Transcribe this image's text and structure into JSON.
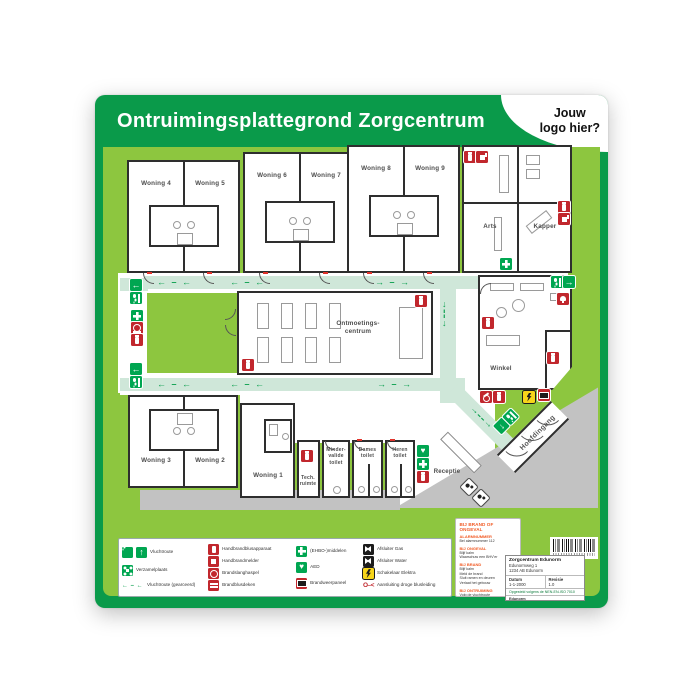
{
  "poster": {
    "title": "Ontruimingsplattegrond Zorgcentrum",
    "logo_placeholder": "Jouw\nlogo hier?"
  },
  "rooms": {
    "w1": "Woning 1",
    "w2": "Woning 2",
    "w3": "Woning 3",
    "w4": "Woning 4",
    "w5": "Woning 5",
    "w6": "Woning 6",
    "w7": "Woning 7",
    "w8": "Woning 8",
    "w9": "Woning 9",
    "arts": "Arts",
    "kapper": "Kapper",
    "winkel": "Winkel",
    "ontmoetingscentrum": "Ontmoetings-\ncentrum",
    "receptie": "Receptie",
    "tech_ruimte": "Tech.\nruimte",
    "mindervalide_toilet": "Minder-\nvalide\ntoilet",
    "dames_toilet": "Dames\ntoilet",
    "heren_toilet": "Heren\ntoilet",
    "hoofdingang": "Hoofdingang"
  },
  "legend": {
    "green": [
      {
        "icon": "escape-route",
        "label": "Vluchtroute"
      },
      {
        "icon": "assembly-point",
        "label": "Verzamelplaats"
      },
      {
        "icon": "route-dashes",
        "label": "Vluchtroute (gearceerd)"
      }
    ],
    "red": [
      {
        "icon": "extinguisher",
        "label": "Handbrandblusapparaat"
      },
      {
        "icon": "manual-call-point",
        "label": "Handbrandmelder"
      },
      {
        "icon": "hose-reel",
        "label": "Brandslanghaspel"
      },
      {
        "icon": "fire-blanket",
        "label": "Brandblusdeken"
      }
    ],
    "aid": [
      {
        "icon": "first-aid",
        "label": "(EHBO-)middelen"
      },
      {
        "icon": "aed",
        "label": "AED"
      },
      {
        "icon": "fire-panel",
        "label": "Brandweerpaneel"
      }
    ],
    "utilities": [
      {
        "icon": "valve",
        "label": "Afsluiter Gas"
      },
      {
        "icon": "valve",
        "label": "Afsluiter Water"
      },
      {
        "icon": "electric-switch",
        "label": "Schakelaar Elektra"
      },
      {
        "icon": "dry-riser",
        "label": "Aansluiting droge blusleiding"
      }
    ]
  },
  "emergency_instructions": {
    "title": "BIJ BRAND OF ONGEVAL",
    "sections": [
      {
        "heading": "ALARMNUMMER",
        "lines": "Bel alarmnummer 112"
      },
      {
        "heading": "BIJ ONGEVAL",
        "lines": "Blijf kalm\nWaarschuw een BHV'er"
      },
      {
        "heading": "BIJ BRAND",
        "lines": "Blijf kalm\nMeld de brand\nSluit ramen en deuren\nVerlaat het gebouw"
      },
      {
        "heading": "BIJ ONTRUIMING",
        "lines": "Volg de vluchtroute\nGebruik geen lift\nGa naar de verzamelplaats"
      }
    ]
  },
  "info_box": {
    "name": "Zorgcentrum Edunorm",
    "address_line1": "Edunormweg 1",
    "address_line2": "1234 AB Edunorm",
    "date_label": "Datum",
    "date_value": "1-1-2000",
    "revision_label": "Revisie",
    "revision_value": "1.0",
    "norm_line": "Opgesteld volgens de NEN-EN-ISO 7010",
    "publisher": "Edunorm"
  },
  "colors": {
    "green_dark": "#0a9a4a",
    "green_light": "#8dc63f",
    "route_mint": "#cfe7d9",
    "safety_red": "#c1272d",
    "safety_green": "#00a651",
    "warning_yellow": "#f7d51a",
    "accent_orange": "#f15a24",
    "plaza_gray": "#c2c2c2"
  },
  "icons": {
    "escape-route": "running man + arrow",
    "assembly-point": "four arrows to centre",
    "extinguisher": "hand fire extinguisher",
    "first-aid": "white cross",
    "aed": "heart + bolt",
    "valve": "bowtie valve",
    "electric-switch": "lightning bolt",
    "dry-riser": "O-<"
  }
}
